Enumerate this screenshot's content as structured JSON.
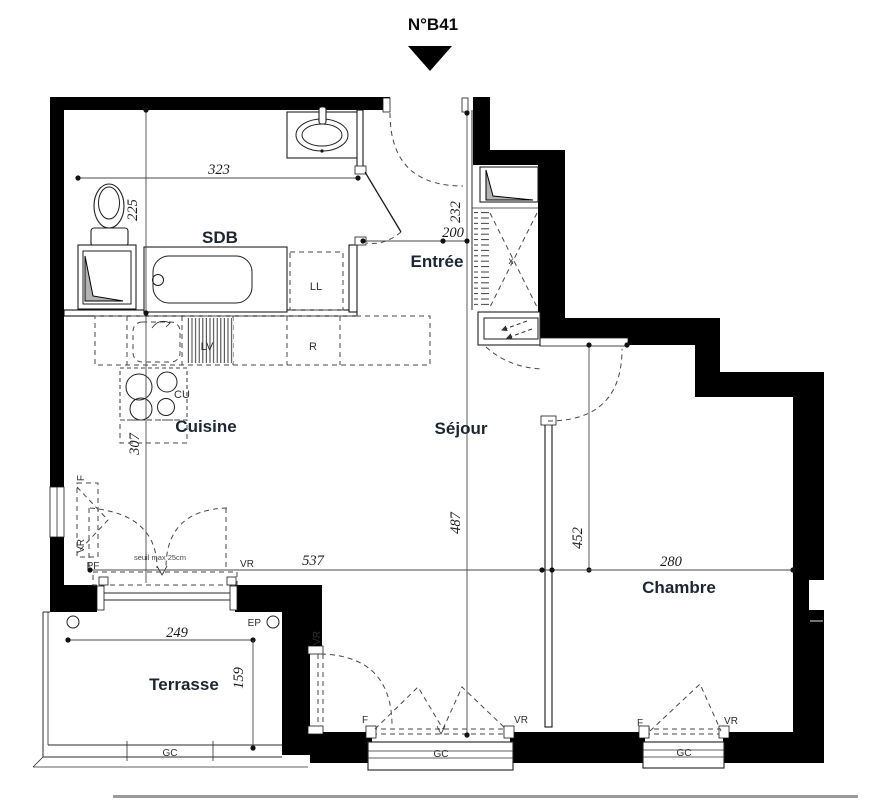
{
  "title": "N°B41",
  "colors": {
    "wall": "#000000",
    "label": "#1b2633",
    "dimension_text": "#1c1c1c",
    "shaft_fill": "#b3b3b3",
    "background": "#ffffff"
  },
  "rooms": {
    "sdb": "SDB",
    "entree": "Entrée",
    "cuisine": "Cuisine",
    "sejour": "Séjour",
    "chambre": "Chambre",
    "terrasse": "Terrasse"
  },
  "dimensions": {
    "sdb_width": "323",
    "sdb_height": "225",
    "entree_height": "232",
    "entree_width": "200",
    "cuisine_height": "307",
    "sejour_height": "487",
    "chambre_height": "452",
    "sejour_width": "537",
    "chambre_width": "280",
    "terrasse_width": "249",
    "terrasse_height": "159"
  },
  "annotations": {
    "washer": "LL",
    "dishwasher": "LV",
    "fridge": "R",
    "cooktop": "CU",
    "closet_mark": "x",
    "window": "F",
    "shutter": "VR",
    "french_door": "PF",
    "guardrail": "GC",
    "rain_pipe": "EP",
    "threshold_note": "seuil max 25cm"
  }
}
